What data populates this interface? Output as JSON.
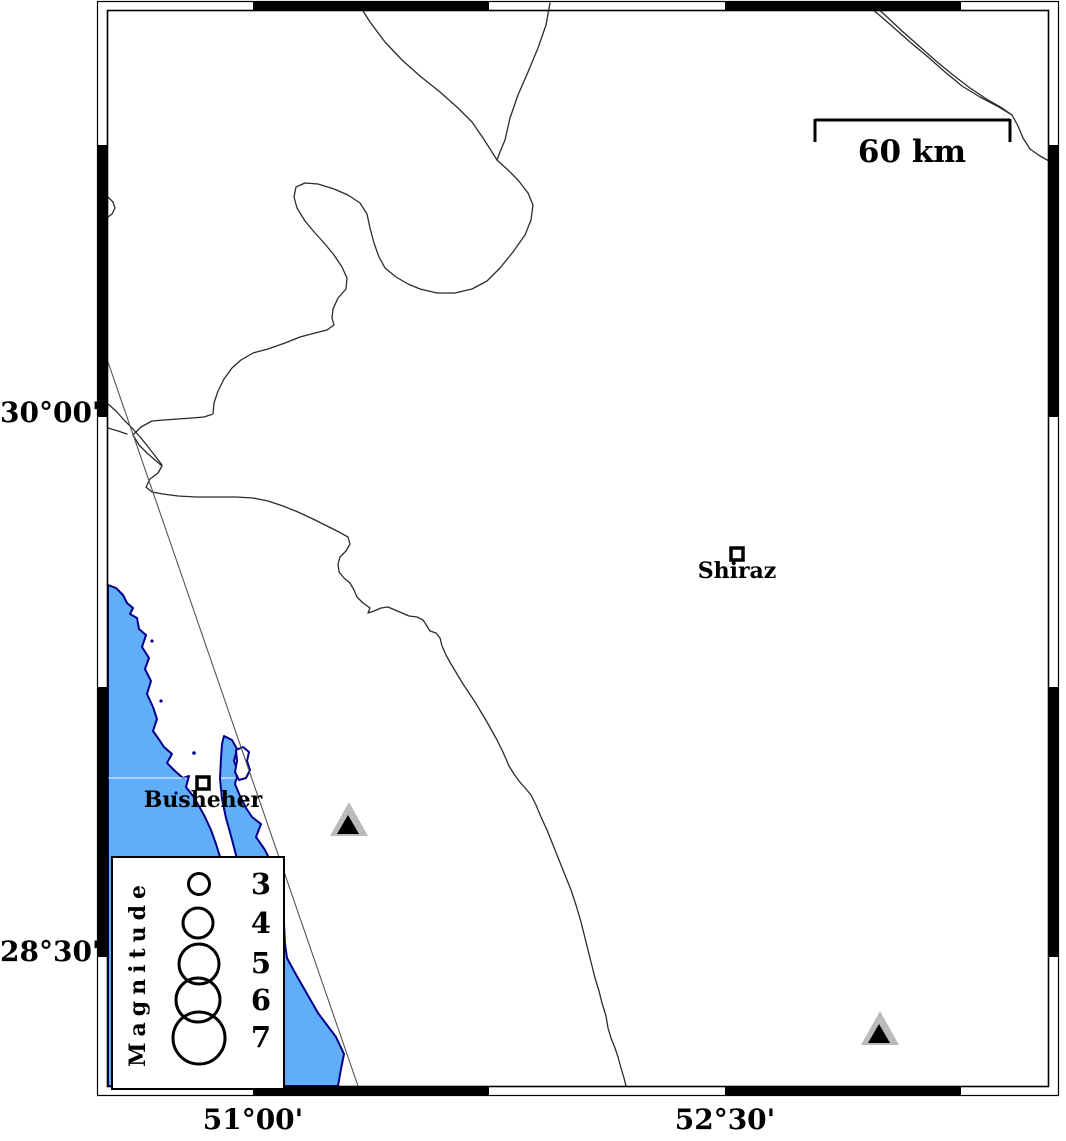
{
  "frame": {
    "lat_ticks": [
      {
        "label": "30°00'"
      },
      {
        "label": "28°30'"
      }
    ],
    "lon_ticks": [
      {
        "label": "51°00'"
      },
      {
        "label": "52°30'"
      }
    ]
  },
  "scale_bar": {
    "label": "60 km"
  },
  "cities": [
    {
      "name": "Shiraz"
    },
    {
      "name": "Busheher"
    }
  ],
  "legend": {
    "title": "Magnitude",
    "items": [
      {
        "magnitude": "3",
        "radius_px": 10.5
      },
      {
        "magnitude": "4",
        "radius_px": 15
      },
      {
        "magnitude": "5",
        "radius_px": 20
      },
      {
        "magnitude": "6",
        "radius_px": 22
      },
      {
        "magnitude": "7",
        "radius_px": 26
      }
    ]
  },
  "stations": {
    "symbol": "triangle",
    "count": 2
  },
  "colors": {
    "water": "#5FAEF7",
    "coastline": "#00008B",
    "boundary_line": "#2b2b2b",
    "fault_line": "#555555",
    "station_outer": "#BBBBBB",
    "station_inner": "#000000",
    "frame": "#000000",
    "gridline_on_water": "rgba(255,255,255,0.6)"
  }
}
